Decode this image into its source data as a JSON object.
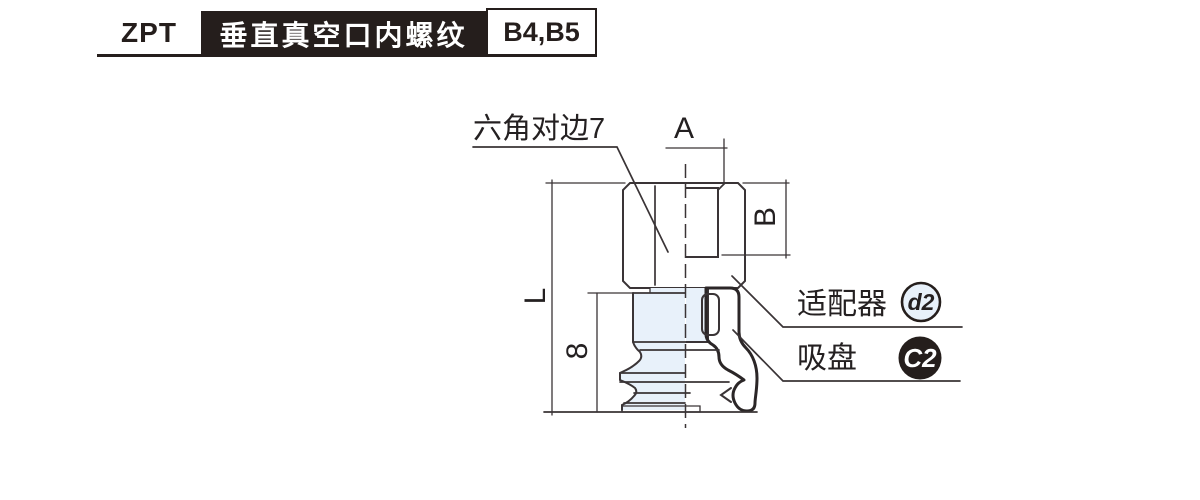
{
  "header": {
    "series": "ZPT",
    "title": "垂直真空口内螺纹",
    "variant": "B4,B5"
  },
  "diagram": {
    "callouts": {
      "hex_flats": "六角对边7",
      "adapter": "适配器",
      "adapter_badge": "d2",
      "pad": "吸盘",
      "pad_badge": "C2"
    },
    "dimensions": {
      "port_width": "A",
      "thread_depth": "B",
      "overall_length": "L",
      "pad_height": "8"
    },
    "colors": {
      "part_fill": "#e8f1fa",
      "line": "#3a3436",
      "badge_dark": "#251e1c",
      "lip_shade": "#9aa1a8"
    }
  }
}
